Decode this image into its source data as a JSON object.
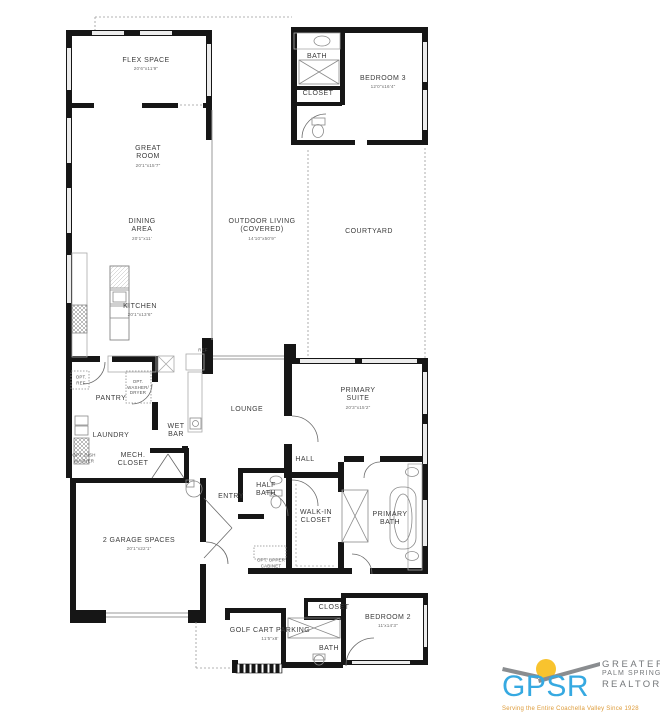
{
  "plan": {
    "rooms": [
      {
        "id": "flex-space",
        "label": "FLEX SPACE",
        "dims": "20'6\"x11'9\"",
        "x": 146,
        "y": 64,
        "dy": 82
      },
      {
        "id": "great-room",
        "label": "GREAT\nROOM",
        "dims": "20'1\"x15'7\"",
        "x": 148,
        "y": 156,
        "dy": 172
      },
      {
        "id": "dining-area",
        "label": "DINING\nAREA",
        "dims": "20'1\"x11'",
        "x": 142,
        "y": 229,
        "dy": 245
      },
      {
        "id": "kitchen",
        "label": "KITCHEN",
        "dims": "20'1\"x13'6\"",
        "x": 140,
        "y": 310,
        "dy": 322
      },
      {
        "id": "outdoor-living",
        "label": "OUTDOOR LIVING\n(COVERED)",
        "dims": "14'10\"x50'9\"",
        "x": 262,
        "y": 229,
        "dy": 246
      },
      {
        "id": "courtyard",
        "label": "COURTYARD",
        "dims": "",
        "x": 369,
        "y": 232,
        "dy": 0
      },
      {
        "id": "bedroom-3",
        "label": "BEDROOM 3",
        "dims": "12'0\"x16'4\"",
        "x": 383,
        "y": 82,
        "dy": 93
      },
      {
        "id": "bath-3",
        "label": "BATH",
        "dims": "",
        "x": 317,
        "y": 57,
        "dy": 0
      },
      {
        "id": "closet-3",
        "label": "CLOSET",
        "dims": "",
        "x": 318,
        "y": 94,
        "dy": 0
      },
      {
        "id": "pantry",
        "label": "PANTRY",
        "dims": "",
        "x": 111,
        "y": 399,
        "dy": 0
      },
      {
        "id": "laundry",
        "label": "LAUNDRY",
        "dims": "",
        "x": 111,
        "y": 436,
        "dy": 0
      },
      {
        "id": "wet-bar",
        "label": "WET\nBAR",
        "dims": "",
        "x": 176,
        "y": 431,
        "dy": 0
      },
      {
        "id": "lounge",
        "label": "LOUNGE",
        "dims": "",
        "x": 247,
        "y": 410,
        "dy": 0
      },
      {
        "id": "primary-suite",
        "label": "PRIMARY\nSUITE",
        "dims": "20'3\"x15'2\"",
        "x": 358,
        "y": 398,
        "dy": 413
      },
      {
        "id": "hall",
        "label": "HALL",
        "dims": "",
        "x": 305,
        "y": 460,
        "dy": 0
      },
      {
        "id": "mech-closet",
        "label": "MECH.\nCLOSET",
        "dims": "",
        "x": 133,
        "y": 460,
        "dy": 0
      },
      {
        "id": "entry",
        "label": "ENTRY",
        "dims": "",
        "x": 231,
        "y": 497,
        "dy": 0
      },
      {
        "id": "half-bath",
        "label": "HALF\nBATH",
        "dims": "",
        "x": 266,
        "y": 490,
        "dy": 0
      },
      {
        "id": "walk-in-closet",
        "label": "WALK-IN\nCLOSET",
        "dims": "",
        "x": 316,
        "y": 517,
        "dy": 0
      },
      {
        "id": "primary-bath",
        "label": "PRIMARY\nBATH",
        "dims": "",
        "x": 390,
        "y": 519,
        "dy": 0
      },
      {
        "id": "garage",
        "label": "2 GARAGE SPACES",
        "dims": "20'1\"x22'1\"",
        "x": 139,
        "y": 544,
        "dy": 556
      },
      {
        "id": "closet-2",
        "label": "CLOSET",
        "dims": "",
        "x": 334,
        "y": 608,
        "dy": 0
      },
      {
        "id": "bedroom-2",
        "label": "BEDROOM 2",
        "dims": "11'x14'3\"",
        "x": 388,
        "y": 621,
        "dy": 633
      },
      {
        "id": "golf-cart",
        "label": "GOLF CART PARKING",
        "dims": "11'5\"x8'",
        "x": 270,
        "y": 634,
        "dy": 644
      },
      {
        "id": "bath-2",
        "label": "BATH",
        "dims": "",
        "x": 329,
        "y": 649,
        "dy": 0
      }
    ],
    "annotations": [
      {
        "id": "opt-ref",
        "label": "OPT.\nREF",
        "x": 81,
        "y": 380
      },
      {
        "id": "opt-washer-dryer",
        "label": "OPT.\nWASHER/\nDRYER",
        "x": 138,
        "y": 387
      },
      {
        "id": "opt-dish-washer",
        "label": "OPT. DISH\nWASHER",
        "x": 84,
        "y": 458
      },
      {
        "id": "opt-upper-cabinet",
        "label": "OPT. UPPER\nCABINET",
        "x": 271,
        "y": 563
      },
      {
        "id": "ref",
        "label": "REF",
        "x": 203,
        "y": 350
      }
    ]
  },
  "logo": {
    "acronym": "GPSR",
    "name_line1": "GREATER",
    "name_line2": "PALM SPRINGS",
    "name_line3": "REALTORS®",
    "tagline": "Serving the Entire Coachella Valley Since 1928",
    "colors": {
      "blue": "#36a9e1",
      "yellow": "#f8c32e",
      "gray": "#75787b",
      "orange": "#dd9a37"
    }
  }
}
